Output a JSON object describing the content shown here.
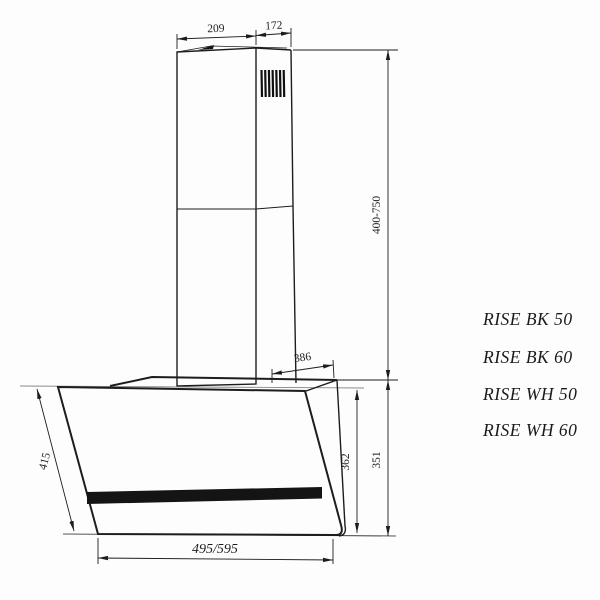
{
  "figure": {
    "type": "technical-drawing",
    "subject": "wall-mounted inclined kitchen hood, side dimensional drawing",
    "line_color": "#1d1d1d",
    "background_color": "#fdfdfd"
  },
  "dimensions": {
    "chimney_width": "209",
    "chimney_depth": "172",
    "chimney_height_range": "400-750",
    "top_depth": "386",
    "glass_height": "362",
    "body_height": "351",
    "glass_length": "415",
    "body_width": "495/595"
  },
  "models": [
    {
      "name": "RISE BK 50"
    },
    {
      "name": "RISE BK 60"
    },
    {
      "name": "RISE WH 50"
    },
    {
      "name": "RISE WH 60"
    }
  ]
}
